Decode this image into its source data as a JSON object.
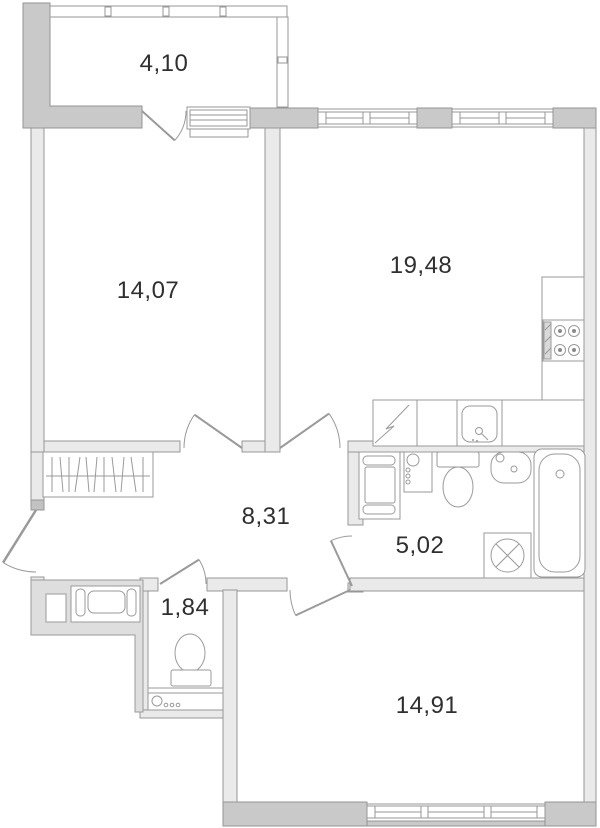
{
  "plan": {
    "title": "apartment-floor-plan",
    "rooms": [
      {
        "id": "balcony",
        "area": "4,10"
      },
      {
        "id": "bedroom",
        "area": "14,07"
      },
      {
        "id": "kitchen-living",
        "area": "19,48"
      },
      {
        "id": "hallway",
        "area": "8,31"
      },
      {
        "id": "bathroom",
        "area": "5,02"
      },
      {
        "id": "wc",
        "area": "1,84"
      },
      {
        "id": "room",
        "area": "14,91"
      }
    ],
    "fixtures": [
      {
        "icon": "stove-icon",
        "room": "kitchen-living"
      },
      {
        "icon": "kitchen-sink-icon",
        "room": "kitchen-living"
      },
      {
        "icon": "fridge-icon",
        "room": "kitchen-living"
      },
      {
        "icon": "bathtub-icon",
        "room": "bathroom"
      },
      {
        "icon": "washbasin-icon",
        "room": "bathroom"
      },
      {
        "icon": "toilet-icon",
        "room": "bathroom"
      },
      {
        "icon": "washing-machine-icon",
        "room": "bathroom"
      },
      {
        "icon": "cabinet-icon",
        "room": "bathroom"
      },
      {
        "icon": "water-riser-icon",
        "room": "bathroom"
      },
      {
        "icon": "toilet-icon",
        "room": "wc"
      },
      {
        "icon": "water-riser-icon",
        "room": "wc"
      },
      {
        "icon": "wardrobe-icon",
        "room": "hallway"
      },
      {
        "icon": "elevator-icon",
        "room": "building-core"
      }
    ],
    "colors": {
      "wall_thick": "#c9c9c9",
      "wall_thin": "#eaeaea",
      "core_fill": "#dedede",
      "outline": "#949494",
      "label": "#2f2f2f",
      "background": "#ffffff"
    }
  }
}
